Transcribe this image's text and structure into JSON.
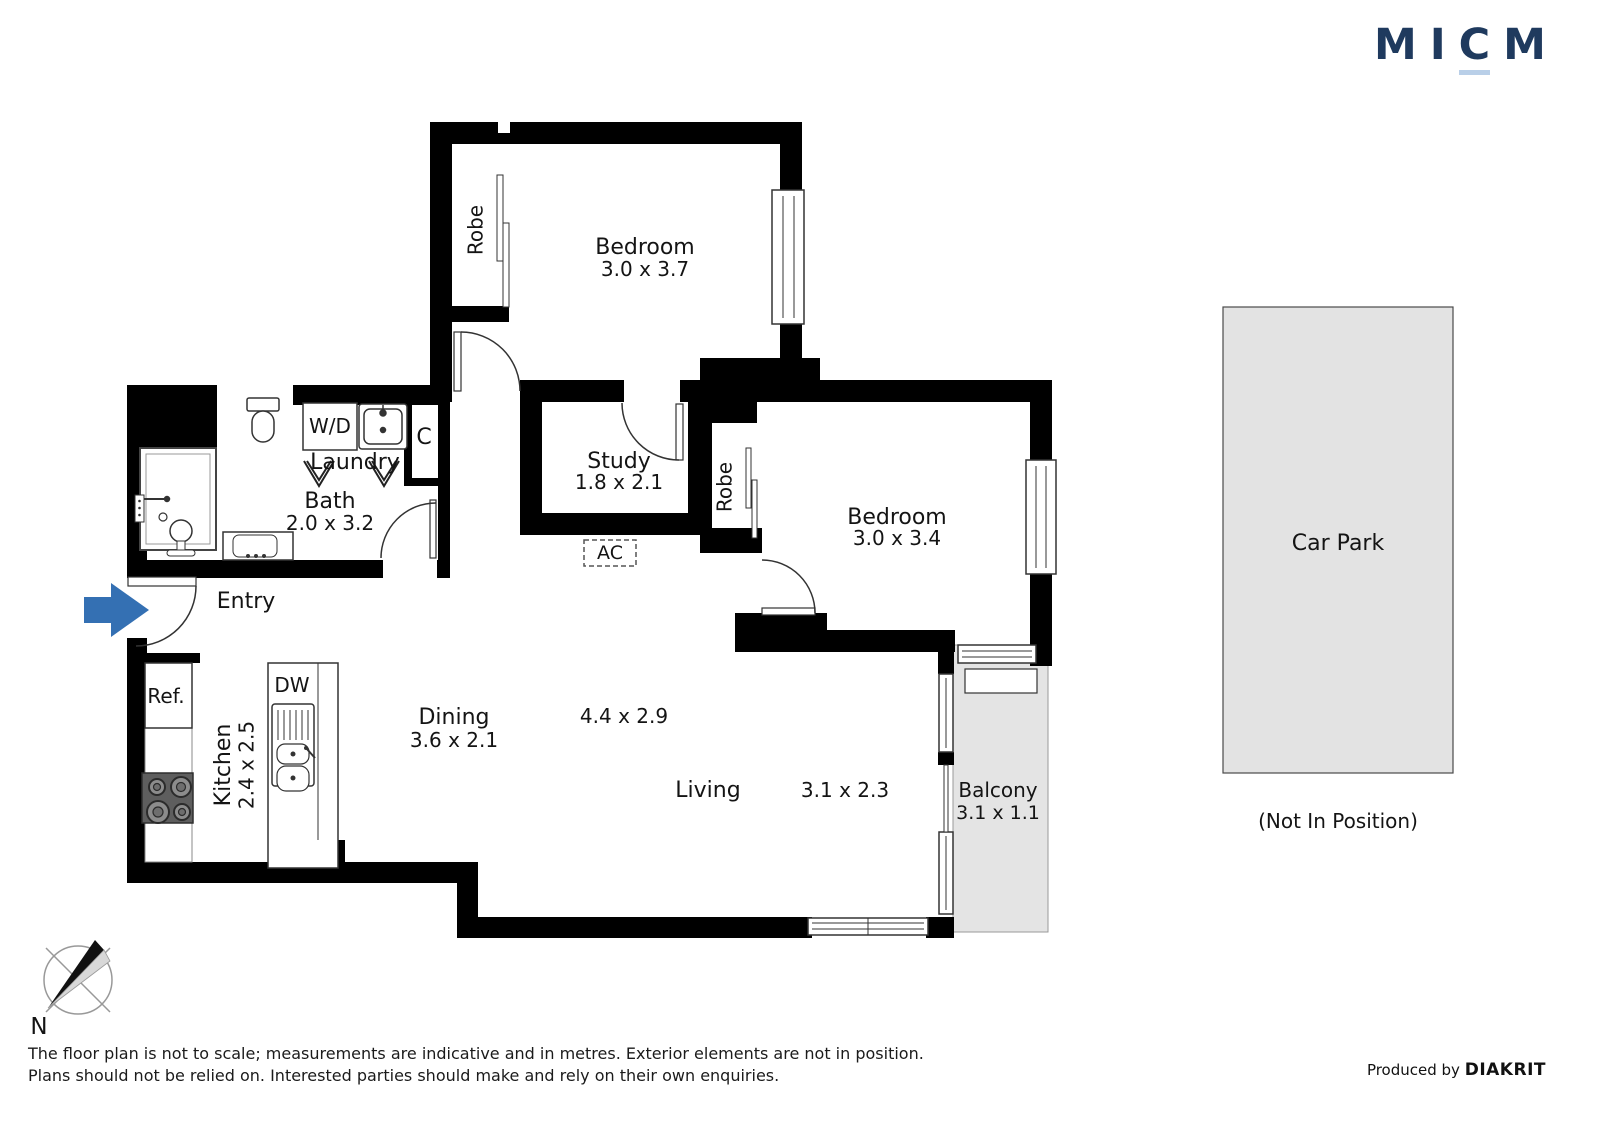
{
  "brand": {
    "letters": [
      "M",
      "I",
      "C",
      "M"
    ],
    "logo_color": "#1f3a5e",
    "underline_color": "#b9cfe8"
  },
  "plan": {
    "rooms": {
      "bedroom1": {
        "name": "Bedroom",
        "dims": "3.0 x 3.7"
      },
      "bedroom2": {
        "name": "Bedroom",
        "dims": "3.0 x 3.4"
      },
      "study": {
        "name": "Study",
        "dims": "1.8 x 2.1"
      },
      "bath": {
        "name": "Bath",
        "dims": "2.0 x 3.2"
      },
      "laundry": {
        "name": "Laundry"
      },
      "entry": {
        "name": "Entry"
      },
      "kitchen": {
        "name": "Kitchen",
        "dims": "2.4 x 2.5"
      },
      "dining": {
        "name": "Dining",
        "dims": "3.6 x 2.1"
      },
      "living": {
        "name": "Living",
        "dims": "3.1 x 2.3"
      },
      "living_dining_overall": "4.4 x 2.9",
      "balcony": {
        "name": "Balcony",
        "dims": "3.1 x 1.1"
      }
    },
    "fixtures": {
      "robe1": "Robe",
      "robe2": "Robe",
      "washer_dryer": "W/D",
      "closet": "C",
      "air_con": "AC",
      "fridge": "Ref.",
      "dishwasher": "DW"
    },
    "car_park": {
      "label": "Car Park",
      "note": "(Not In Position)"
    },
    "compass": {
      "north": "N"
    }
  },
  "footer": {
    "disclaimer_line1": "The floor plan is not to scale; measurements are indicative and in metres. Exterior elements are not in position.",
    "disclaimer_line2": "Plans should not be relied on. Interested parties should make and rely on their own enquiries.",
    "produced_by": "Produced by",
    "producer": "DIAKRIT"
  },
  "colors": {
    "wall": "#000000",
    "entry_arrow": "#3470b3",
    "balcony_fill": "#e4e4e4",
    "car_park_fill": "#e3e3e3"
  }
}
